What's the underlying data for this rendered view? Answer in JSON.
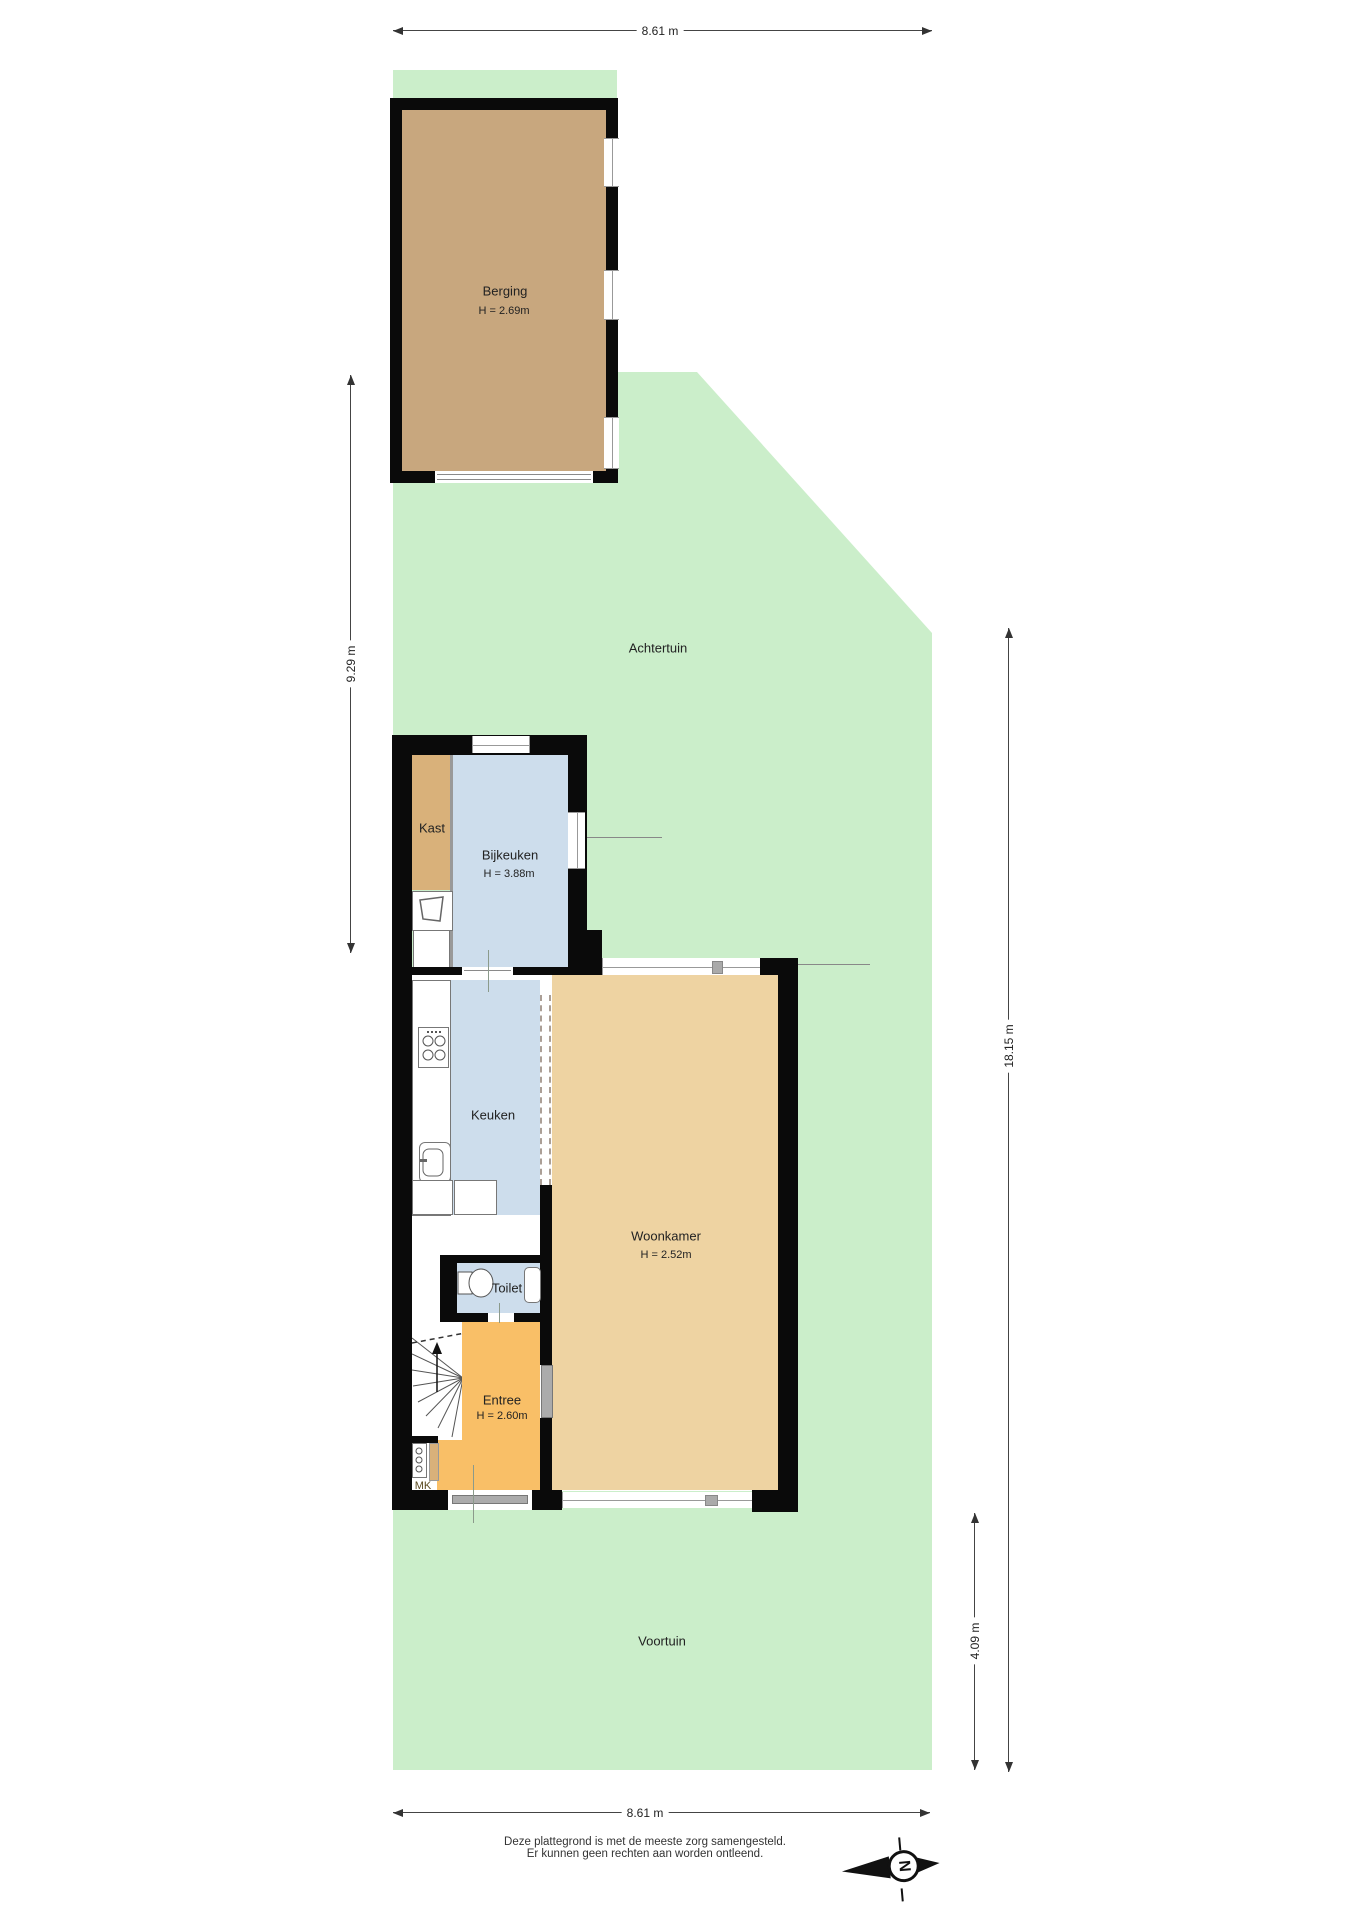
{
  "dimensions": {
    "top": "8.61 m",
    "left": "9.29 m",
    "right_long": "18.15 m",
    "right_short": "4.09 m",
    "bottom": "8.61 m"
  },
  "areas": {
    "achtertuin": "Achtertuin",
    "voortuin": "Voortuin"
  },
  "rooms": {
    "berging": {
      "label": "Berging",
      "height": "H = 2.69m"
    },
    "kast": {
      "label": "Kast"
    },
    "bijkeuken": {
      "label": "Bijkeuken",
      "height": "H = 3.88m"
    },
    "keuken": {
      "label": "Keuken"
    },
    "woonkamer": {
      "label": "Woonkamer",
      "height": "H = 2.52m"
    },
    "toilet": {
      "label": "Toilet"
    },
    "entree": {
      "label": "Entree",
      "height": "H = 2.60m"
    },
    "mk": {
      "label": "MK"
    }
  },
  "compass": {
    "letter": "N"
  },
  "footer": {
    "line1": "Deze plattegrond is met de meeste zorg samengesteld.",
    "line2": "Er kunnen geen rechten aan worden ontleend."
  },
  "colors": {
    "garden": "#cbeeca",
    "walls": "#0a0a0a",
    "berging_floor": "#c8a77e",
    "kast_floor": "#d9b17a",
    "wet_room_floor": "#cdddec",
    "woonkamer_floor": "#eed3a2",
    "entree_floor": "#f9bf67"
  }
}
